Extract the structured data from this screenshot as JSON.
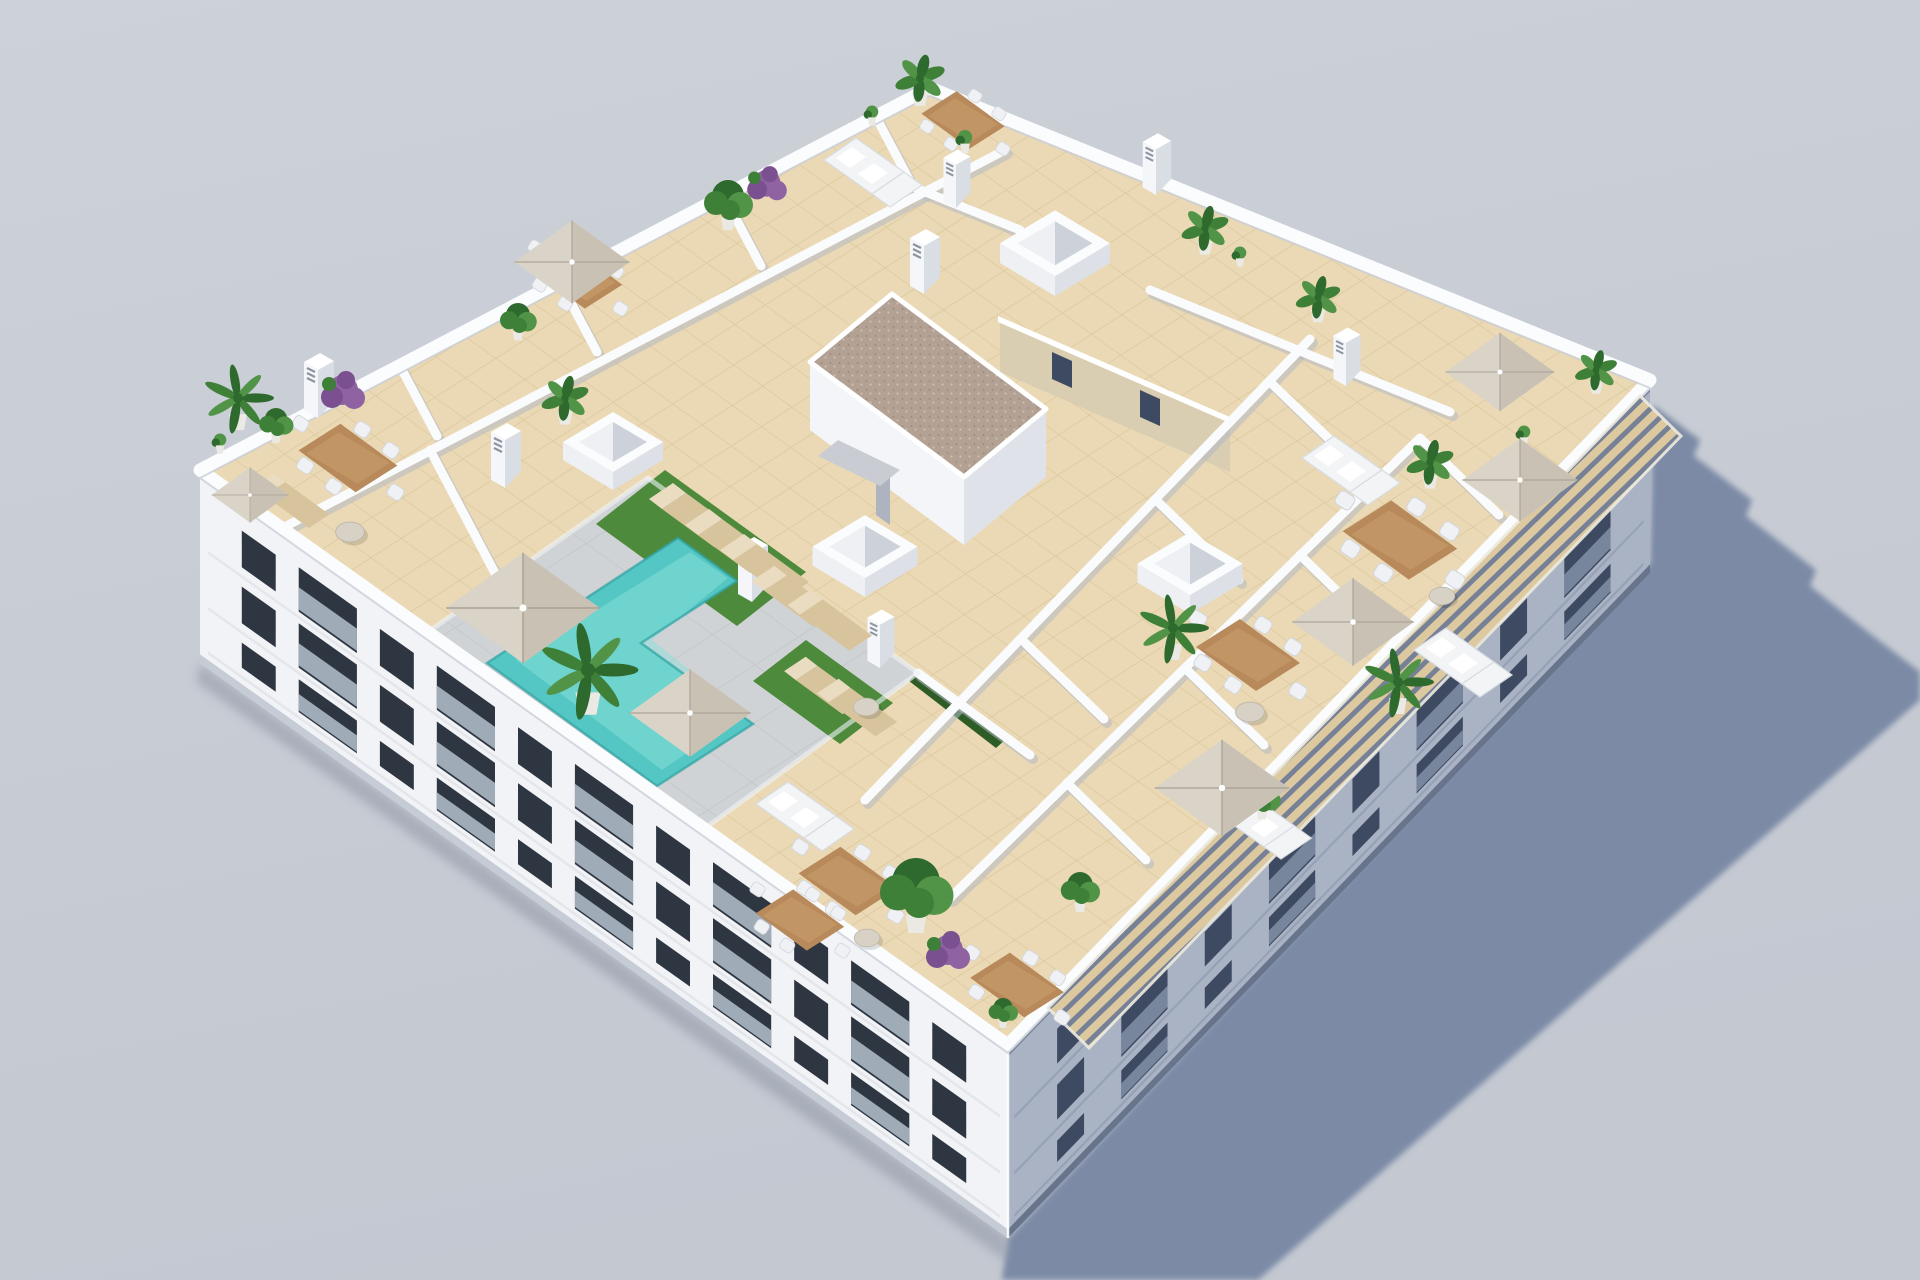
{
  "scene": {
    "description": "Aerial isometric 3D architectural rendering of a white apartment building rooftop with private tiled terraces, an L-shaped turquoise pool on a grey deck, artificial grass, parasols, dining sets, sofas, loungers, plants, skylights and chimneys; long cast shadow on grey ground to the lower right",
    "colors": {
      "bg1": "#cdd1d8",
      "bg2": "#c3c8d1",
      "shadow": "#7b8aa6",
      "ground-ao": "#8f96a4",
      "facade-sw": "#f2f3f6",
      "facade-se": "#a9b3c4",
      "cornice": "#fbfcfe",
      "wall": "#fafbfd",
      "wall-sh": "#b4bac6",
      "tile": "#ead9b4",
      "tile-line": "#dcc89e",
      "deck": "#d0d3d6",
      "deck-line": "#c3c6ca",
      "pool": "#54c6c3",
      "pool-hi": "#8adfda",
      "pool-edge": "#2fa3a2",
      "grass": "#4d8a3b",
      "hedge": "#2e5c26",
      "glass-fence": "#eef4f6",
      "umb": "#d9d3c8",
      "umb-sh": "#c3bcae",
      "umb-rib": "#aba496",
      "wood": "#b8895a",
      "wood-hi": "#cfa371",
      "chair": "#eff1f4",
      "sofa": "#f3f4f6",
      "lounger": "#d8c49c",
      "lounger-hi": "#e9dcc0",
      "rtable": "#d8d2c6",
      "gravel": "#b3a294",
      "gravel-d1": "#9c8d80",
      "gravel-d2": "#cfc2b5",
      "tan": "#d9cdb2",
      "win-sw": "#2e3642",
      "glass-sw": "#b3c0cb",
      "win-se": "#3e4a61",
      "glass-se": "#8795ad",
      "slat": "#dcc9a0",
      "slat-gap": "#76descending",
      "slat-gap2": "#768096",
      "pot": "#ebe9e3",
      "g1": "#2e6a2d",
      "g2": "#3f8038",
      "g3": "#529447",
      "purple": "#8f63a2",
      "purple2": "#7a5090",
      "skylight-a": "#eef0f4",
      "skylight-b": "#dde0e7",
      "skylight-c": "#fbfcfe",
      "skylight-d": "#cdd2da",
      "chimney-a": "#ffffff",
      "chimney-b": "#f4f6f9",
      "chimney-c": "#d9dde4",
      "chimney-slot": "#8d93a0",
      "steps": "#c9ccd2"
    },
    "walls": [
      [
        [
          250,
          545
        ],
        [
          1005,
          150
        ]
      ],
      [
        [
          400,
          366
        ],
        [
          437,
          436
        ]
      ],
      [
        [
          560,
          282
        ],
        [
          597,
          352
        ]
      ],
      [
        [
          724,
          196
        ],
        [
          761,
          266
        ]
      ],
      [
        [
          876,
          117
        ],
        [
          913,
          187
        ]
      ],
      [
        [
          913,
          187
        ],
        [
          1020,
          230
        ]
      ],
      [
        [
          430,
          450
        ],
        [
          505,
          592
        ]
      ],
      [
        [
          865,
          800
        ],
        [
          1310,
          339
        ]
      ],
      [
        [
          950,
          898
        ],
        [
          1420,
          438
        ]
      ],
      [
        [
          1021,
          639
        ],
        [
          1104,
          719
        ]
      ],
      [
        [
          1156,
          500
        ],
        [
          1239,
          580
        ]
      ],
      [
        [
          1270,
          382
        ],
        [
          1353,
          462
        ]
      ],
      [
        [
          1067,
          783
        ],
        [
          1146,
          860
        ]
      ],
      [
        [
          1185,
          668
        ],
        [
          1264,
          745
        ]
      ],
      [
        [
          1300,
          555
        ],
        [
          1379,
          632
        ]
      ],
      [
        [
          1420,
          438
        ],
        [
          1499,
          515
        ]
      ],
      [
        [
          1150,
          290
        ],
        [
          1450,
          412
        ]
      ],
      [
        [
          918,
          673
        ],
        [
          1030,
          755
        ]
      ]
    ],
    "glass": [
      [
        [
          648,
          478
        ],
        [
          918,
          673
        ]
      ],
      [
        [
          918,
          673
        ],
        [
          660,
          861
        ]
      ],
      [
        [
          648,
          478
        ],
        [
          395,
          655
        ]
      ],
      [
        [
          560,
          808
        ],
        [
          1000,
          1042
        ]
      ]
    ],
    "facades": [
      {
        "target": "sw",
        "floors": [
          [
            0.14,
            0.23
          ],
          [
            0.43,
            0.23
          ],
          [
            0.72,
            0.17
          ]
        ],
        "bays": 11,
        "margin": 0.03
      },
      {
        "target": "se",
        "floors": [
          [
            0.16,
            0.22
          ],
          [
            0.45,
            0.22
          ],
          [
            0.74,
            0.15
          ]
        ],
        "bays": 8,
        "margin": 0.04
      }
    ],
    "objects": [
      {
        "t": "skylight",
        "x": 613,
        "y": 450,
        "s": 1.0
      },
      {
        "t": "skylight",
        "x": 865,
        "y": 555,
        "s": 1.05
      },
      {
        "t": "skylight",
        "x": 1055,
        "y": 252,
        "s": 1.1
      },
      {
        "t": "skylight",
        "x": 1190,
        "y": 572,
        "s": 1.05
      },
      {
        "t": "chimney",
        "x": 318,
        "y": 398,
        "s": 1
      },
      {
        "t": "chimney",
        "x": 505,
        "y": 468,
        "s": 1
      },
      {
        "t": "chimney",
        "x": 752,
        "y": 582,
        "s": 1
      },
      {
        "t": "chimney",
        "x": 924,
        "y": 274,
        "s": 1
      },
      {
        "t": "chimney",
        "x": 956,
        "y": 190,
        "s": 0.9
      },
      {
        "t": "chimney",
        "x": 1156,
        "y": 176,
        "s": 0.95
      },
      {
        "t": "chimney",
        "x": 1346,
        "y": 368,
        "s": 0.9
      },
      {
        "t": "chimney",
        "x": 880,
        "y": 650,
        "s": 0.9
      },
      {
        "t": "dining",
        "x": 348,
        "y": 458,
        "s": 0.95
      },
      {
        "t": "dining",
        "x": 578,
        "y": 278,
        "s": 0.85
      },
      {
        "t": "dining",
        "x": 963,
        "y": 120,
        "s": 0.8
      },
      {
        "t": "dining",
        "x": 1400,
        "y": 540,
        "s": 1.1
      },
      {
        "t": "dining",
        "x": 1248,
        "y": 655,
        "s": 1.0
      },
      {
        "t": "dining",
        "x": 1017,
        "y": 985,
        "s": 0.9
      },
      {
        "t": "dining",
        "x": 848,
        "y": 881,
        "s": 0.95
      },
      {
        "t": "dining",
        "x": 800,
        "y": 920,
        "s": 0.85
      },
      {
        "t": "sofa",
        "x": 870,
        "y": 168,
        "s": 1.0
      },
      {
        "t": "sofa",
        "x": 1348,
        "y": 466,
        "s": 1.0
      },
      {
        "t": "sofa",
        "x": 1460,
        "y": 658,
        "s": 1.0
      },
      {
        "t": "sofa",
        "x": 1262,
        "y": 822,
        "s": 0.95
      },
      {
        "t": "sofa",
        "x": 802,
        "y": 812,
        "s": 1.0
      },
      {
        "t": "lounger",
        "x": 700,
        "y": 520,
        "s": 1
      },
      {
        "t": "lounger",
        "x": 736,
        "y": 546,
        "s": 1
      },
      {
        "t": "lounger",
        "x": 771,
        "y": 571,
        "s": 1
      },
      {
        "t": "lounger",
        "x": 830,
        "y": 690,
        "s": 0.9
      },
      {
        "t": "lounger",
        "x": 863,
        "y": 712,
        "s": 0.9
      },
      {
        "t": "lounger",
        "x": 800,
        "y": 601,
        "s": 0.95
      },
      {
        "t": "lounger",
        "x": 836,
        "y": 625,
        "s": 0.95
      },
      {
        "t": "lounger",
        "x": 297,
        "y": 505,
        "s": 0.85
      },
      {
        "t": "roundtable",
        "x": 350,
        "y": 532,
        "s": 0.9
      },
      {
        "t": "roundtable",
        "x": 866,
        "y": 707,
        "s": 0.8
      },
      {
        "t": "roundtable",
        "x": 1250,
        "y": 712,
        "s": 0.9
      },
      {
        "t": "roundtable",
        "x": 867,
        "y": 938,
        "s": 0.8
      },
      {
        "t": "roundtable",
        "x": 1442,
        "y": 596,
        "s": 0.8
      },
      {
        "t": "palm",
        "x": 238,
        "y": 398,
        "s": 1.0
      },
      {
        "t": "palm",
        "x": 588,
        "y": 670,
        "s": 1.4
      },
      {
        "t": "palm",
        "x": 1173,
        "y": 628,
        "s": 1.0
      },
      {
        "t": "palm",
        "x": 1398,
        "y": 682,
        "s": 1.0
      },
      {
        "t": "banana",
        "x": 920,
        "y": 78,
        "s": 1.0
      },
      {
        "t": "banana",
        "x": 1205,
        "y": 228,
        "s": 0.95
      },
      {
        "t": "banana",
        "x": 1318,
        "y": 297,
        "s": 0.9
      },
      {
        "t": "banana",
        "x": 1430,
        "y": 462,
        "s": 0.95
      },
      {
        "t": "banana",
        "x": 1596,
        "y": 370,
        "s": 0.85
      },
      {
        "t": "banana",
        "x": 565,
        "y": 398,
        "s": 0.95
      },
      {
        "t": "green",
        "x": 728,
        "y": 200,
        "s": 1.0
      },
      {
        "t": "green",
        "x": 916,
        "y": 888,
        "s": 1.5
      },
      {
        "t": "green",
        "x": 276,
        "y": 422,
        "s": 0.7
      },
      {
        "t": "green",
        "x": 518,
        "y": 318,
        "s": 0.75
      },
      {
        "t": "green",
        "x": 1080,
        "y": 888,
        "s": 0.8
      },
      {
        "t": "green",
        "x": 1262,
        "y": 797,
        "s": 0.75
      },
      {
        "t": "green",
        "x": 1003,
        "y": 1010,
        "s": 0.6
      },
      {
        "t": "purple",
        "x": 343,
        "y": 392,
        "s": 1.0
      },
      {
        "t": "purple",
        "x": 767,
        "y": 185,
        "s": 0.9
      },
      {
        "t": "purple",
        "x": 948,
        "y": 952,
        "s": 1.0
      },
      {
        "t": "pot",
        "x": 965,
        "y": 142,
        "s": 0.8
      },
      {
        "t": "pot",
        "x": 1240,
        "y": 257,
        "s": 0.7
      },
      {
        "t": "pot",
        "x": 220,
        "y": 444,
        "s": 0.7
      },
      {
        "t": "pot",
        "x": 1524,
        "y": 436,
        "s": 0.7
      },
      {
        "t": "pot",
        "x": 872,
        "y": 116,
        "s": 0.7
      },
      {
        "t": "umbrella",
        "x": 572,
        "y": 262,
        "s": 0.9
      },
      {
        "t": "umbrella",
        "x": 523,
        "y": 608,
        "s": 1.2
      },
      {
        "t": "umbrella",
        "x": 690,
        "y": 713,
        "s": 0.95
      },
      {
        "t": "umbrella",
        "x": 1500,
        "y": 372,
        "s": 0.85
      },
      {
        "t": "umbrella",
        "x": 1520,
        "y": 480,
        "s": 0.9
      },
      {
        "t": "umbrella",
        "x": 1353,
        "y": 622,
        "s": 0.95
      },
      {
        "t": "umbrella",
        "x": 1222,
        "y": 788,
        "s": 1.05
      },
      {
        "t": "umbrella",
        "x": 250,
        "y": 495,
        "s": 0.6
      }
    ]
  }
}
